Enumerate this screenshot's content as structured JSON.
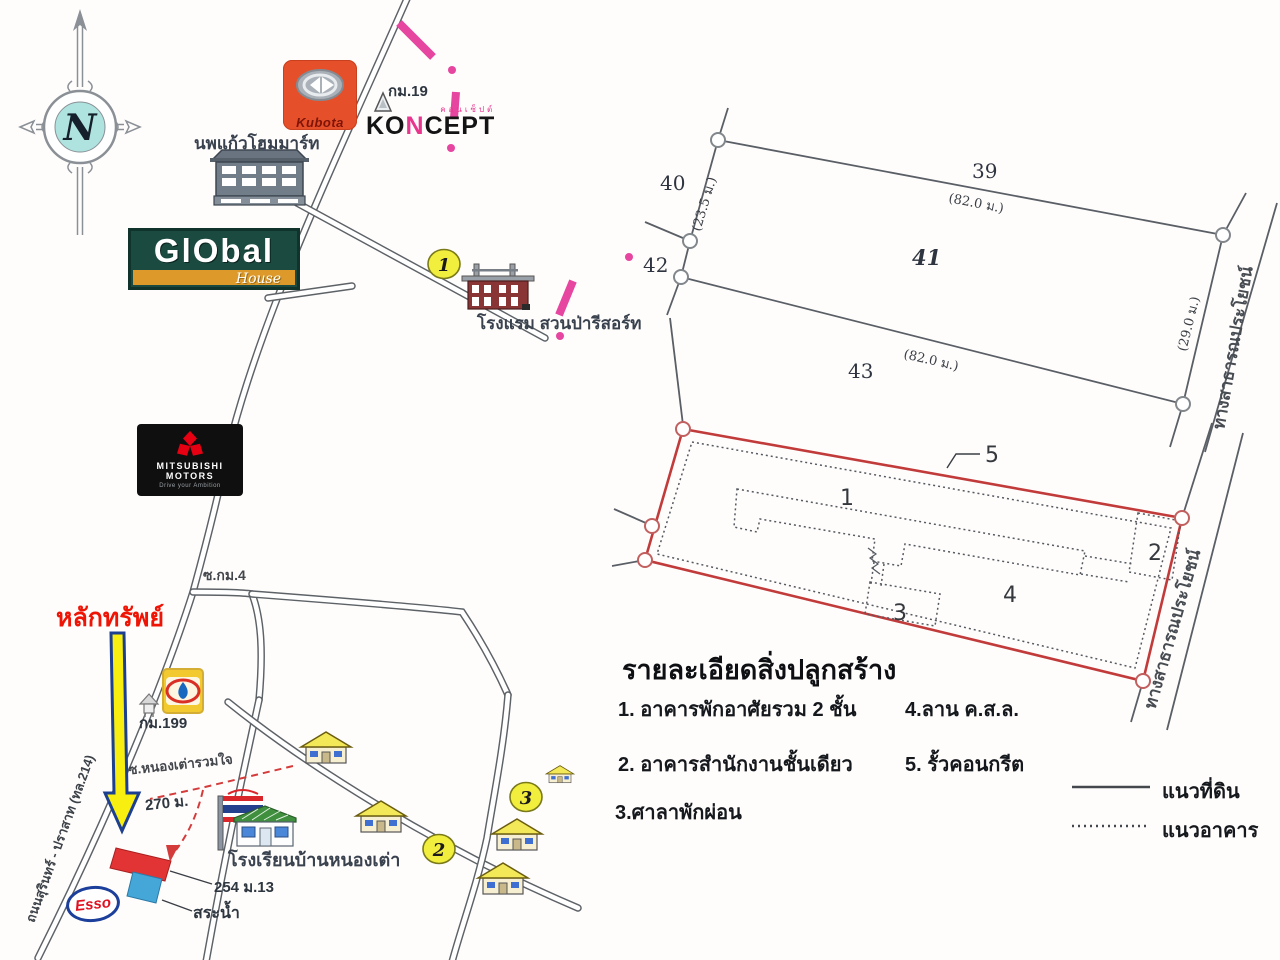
{
  "compass": {
    "north": "N"
  },
  "landmarks": {
    "kubota": "Kubota",
    "koncept_ko": "KO",
    "koncept_n": "N",
    "koncept_cept": "CEPT",
    "koncept_thai": "คอนเซ็ปต์",
    "homemart": "นพแก้วโฮมมาร์ท",
    "global_main": "GlObal",
    "global_sub": "House",
    "mitsubishi_1": "MITSUBISHI",
    "mitsubishi_2": "MOTORS",
    "mitsubishi_tag": "Drive your Ambition",
    "hotel": "โรงแรม สวนป่ารีสอร์ท",
    "school": "โรงเรียนบ้านหนองเต่า",
    "esso": "Esso"
  },
  "labels": {
    "km19": "กม.19",
    "km199": "กม.199",
    "soi_km4": "ซ.กม.4",
    "soi_nongtao": "ซ.หนองเต่ารวมใจ",
    "dist_270": "270 ม.",
    "subject": "หลักทรัพย์",
    "address": "254 ม.13",
    "pond": "สระน้ำ",
    "road_surin": "ถนนสุรินทร์ - ปราสาท (ทล.214)"
  },
  "markers": {
    "m1": "1",
    "m2": "2",
    "m3": "3"
  },
  "parcel_diagram": {
    "p39": "39",
    "p40": "40",
    "p41": "41",
    "p42": "42",
    "p43": "43",
    "dim_top": "(82.0 ม.)",
    "dim_bottom": "(82.0 ม.)",
    "dim_left": "(23.5 ม.)",
    "dim_right": "(29.0 ม.)",
    "road": "ทางสาธารณประโยชน์"
  },
  "site_plan": {
    "n1": "1",
    "n2": "2",
    "n3": "3",
    "n4": "4",
    "n5": "5",
    "road": "ทางสาธารณประโยชน์"
  },
  "legend": {
    "title": "รายละเอียดสิ่งปลูกสร้าง",
    "col1": [
      "1. อาคารพักอาศัยรวม 2 ชั้น",
      "2. อาคารสำนักงานชั้นเดียว",
      "3.ศาลาพักผ่อน"
    ],
    "col2": [
      "4.ลาน ค.ส.ล.",
      "5. รั้วคอนกรีต"
    ],
    "solid": "แนวที่ดิน",
    "dotted": "แนวอาคาร"
  }
}
